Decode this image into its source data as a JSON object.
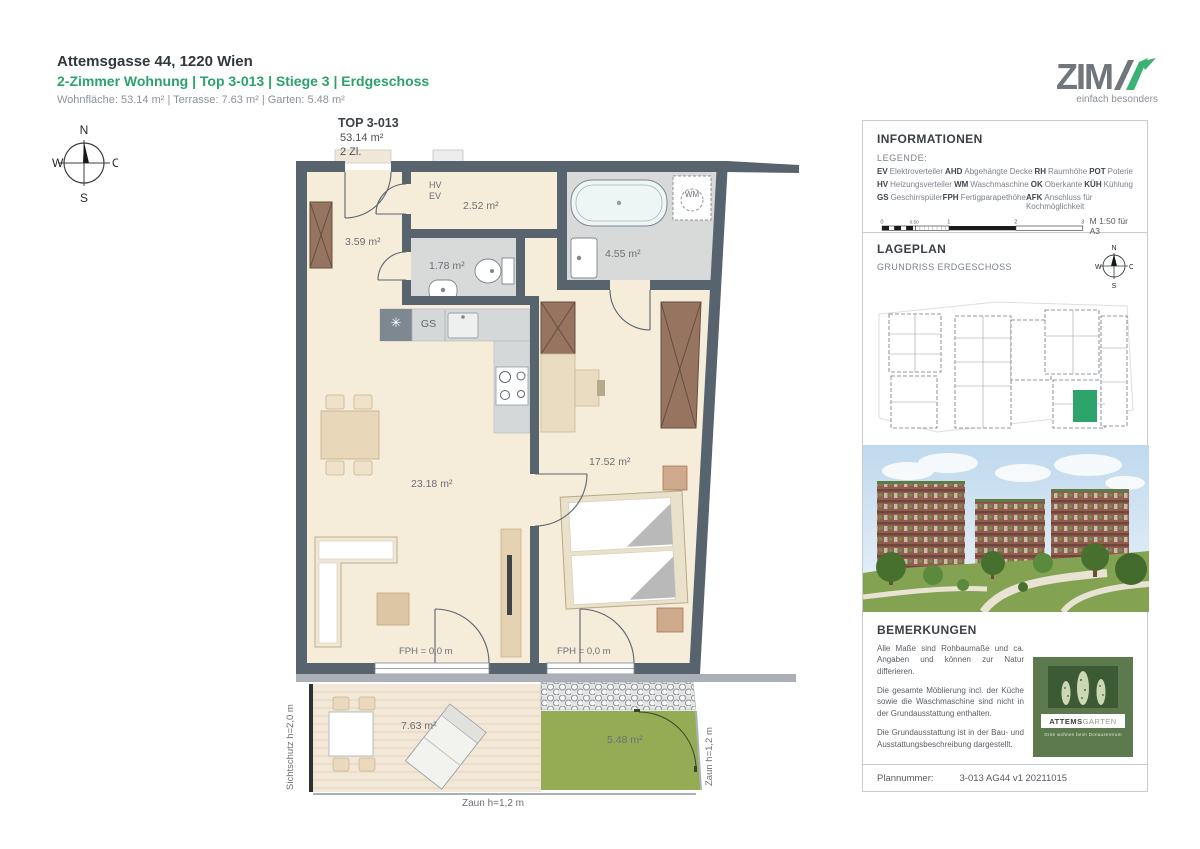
{
  "header": {
    "address": "Attemsgasse 44, 1220 Wien",
    "subtitle": "2-Zimmer Wohnung | Top 3-013 | Stiege 3 | Erdgeschoss",
    "areas": "Wohnfläche: 53.14 m²  |  Terrasse: 7.63 m²  |  Garten: 5.48 m²"
  },
  "logo": {
    "name": "ZIM",
    "tagline": "einfach besonders"
  },
  "compass": {
    "n": "N",
    "o": "O",
    "s": "S",
    "w": "W"
  },
  "plan": {
    "title": "TOP 3-013",
    "area_total": "53.14 m²",
    "rooms_count": "2 Zl.",
    "labels": {
      "hv": "HV",
      "ev": "EV",
      "storage_area": "2.52 m²",
      "hall_area": "3.59 m²",
      "wc_area": "1.78 m²",
      "bath_area": "4.55 m²",
      "wm": "WM",
      "gs": "GS",
      "afk_symbol": "✳",
      "living_area": "23.18 m²",
      "bedroom_area": "17.52 m²",
      "fph": "FPH = 0,0 m",
      "terrace_area": "7.63 m²",
      "garden_area": "5.48 m²",
      "fence": "Zaun h=1,2 m",
      "privacy_screen": "Sichtschutz h=2,0 m"
    }
  },
  "info_panel": {
    "title": "INFORMATIONEN",
    "legend_label": "LEGENDE:",
    "legend": [
      {
        "abbr": "EV",
        "term": "Elektroverteiler"
      },
      {
        "abbr": "AHD",
        "term": "Abgehängte Decke"
      },
      {
        "abbr": "RH",
        "term": "Raumhöhe"
      },
      {
        "abbr": "POT",
        "term": "Poterie"
      },
      {
        "abbr": "HV",
        "term": "Heizungsverteiler"
      },
      {
        "abbr": "WM",
        "term": "Waschmaschine"
      },
      {
        "abbr": "OK",
        "term": "Oberkante"
      },
      {
        "abbr": "KÜH",
        "term": "Kühlung"
      },
      {
        "abbr": "GS",
        "term": "Geschirrspüler"
      },
      {
        "abbr": "FPH",
        "term": "Fertigparapethöhe"
      },
      {
        "abbr": "AFK",
        "term": "Anschluss für Kochmöglichkeit"
      }
    ],
    "scale": {
      "ticks": [
        "0",
        "0.50",
        "1",
        "2",
        "3"
      ],
      "note": "M 1:50 für A3"
    }
  },
  "lageplan": {
    "title": "LAGEPLAN",
    "subtitle": "GRUNDRISS ERDGESCHOSS"
  },
  "bemerkungen": {
    "title": "BEMERKUNGEN",
    "paragraphs": [
      "Alle Maße sind Rohbaumaße und ca. Angaben und können zur Natur differieren.",
      "Die gesamte Möblierung incl. der Küche sowie die Waschmaschine sind nicht in der Grundausstattung enthalten.",
      "Die Grundausstattung ist in der Bau- und Ausstattungsbeschreibung dargestellt."
    ],
    "brand": {
      "name_bold": "ATTEMS",
      "name_light": "GARTEN",
      "tagline": "Grün wohnen beim Donauzentrum"
    }
  },
  "footer": {
    "plannumber_label": "Plannummer:",
    "plannumber": "3-013 AG44 v1 20211015"
  },
  "colors": {
    "accent_green": "#2ba26b",
    "wall": "#57636d",
    "garden_green": "#95ac55"
  }
}
